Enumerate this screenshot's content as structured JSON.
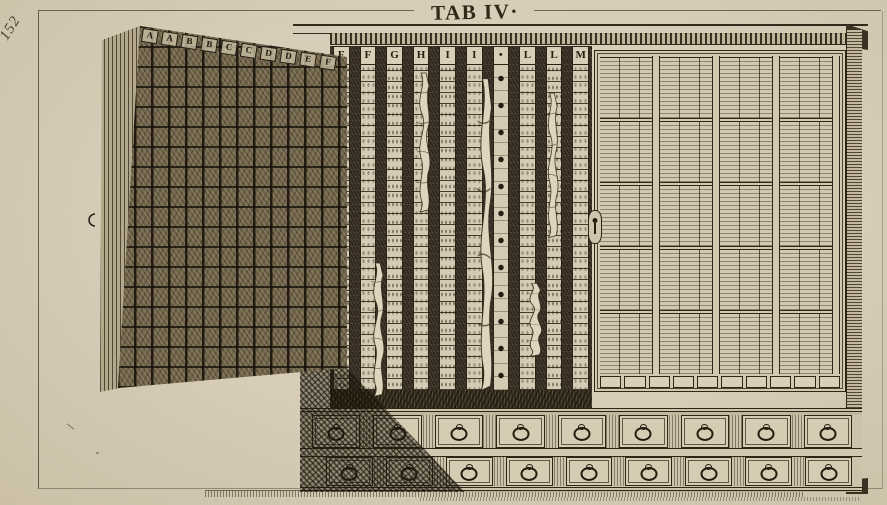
{
  "plate": {
    "page_number": "152",
    "title": "TAB IV·",
    "paper_color": "#d7ccb6",
    "ink_color": "#2e271c"
  },
  "cabinet": {
    "open_door": {
      "letters": [
        "A",
        "A",
        "B",
        "B",
        "C",
        "C",
        "D",
        "D",
        "E",
        "F"
      ]
    },
    "interior": {
      "header_letters": [
        "F",
        "F",
        "G",
        "H",
        "I",
        "I",
        "•",
        "L",
        "L",
        "M"
      ],
      "column_count": 10,
      "dotted_column_index": 7,
      "specimen_count": 5
    },
    "right_door": {
      "panel_columns": 4,
      "panel_rows": 5,
      "subcolumns_per_cell": 3,
      "bottom_cell_count": 10
    },
    "drawers": {
      "rows": 2,
      "per_row": 9,
      "pull": "ring"
    }
  }
}
